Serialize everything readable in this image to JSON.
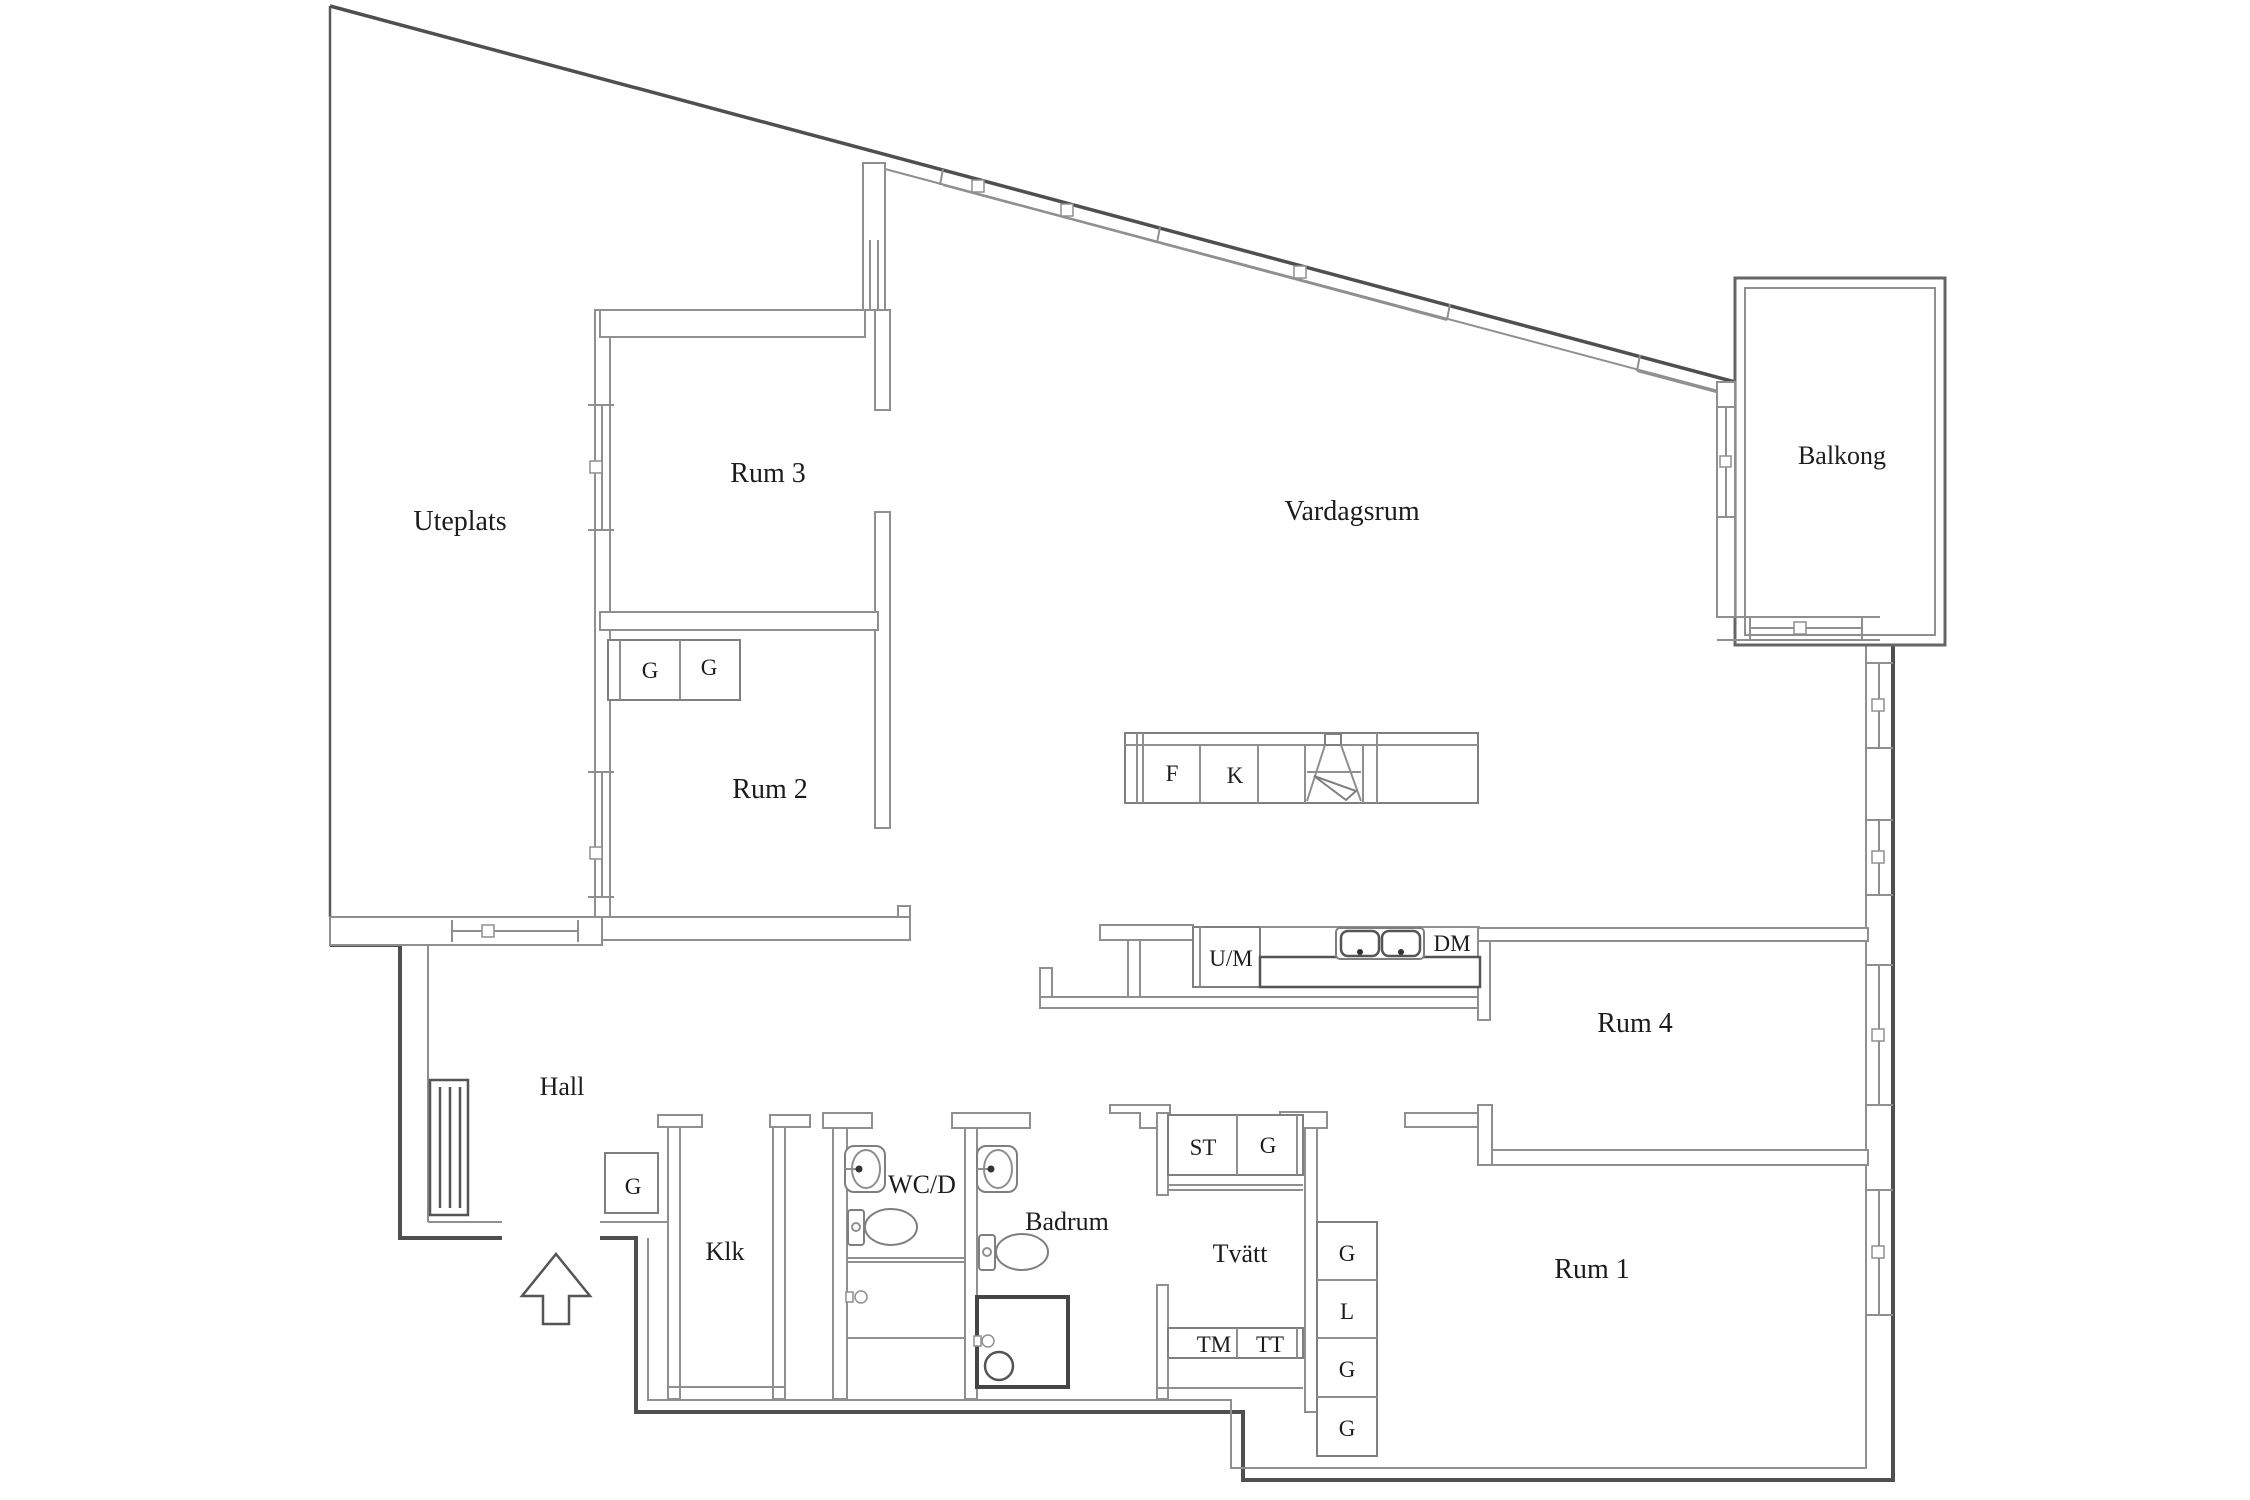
{
  "document": {
    "type": "architectural floor plan",
    "background": "#ffffff"
  },
  "colors": {
    "outer_wall": "#4f4f4f",
    "inner_wall": "#8f8f8f",
    "fixture_line": "#7f7f7f",
    "shower_outline": "#454545",
    "label_text": "#1c1c1c"
  },
  "rooms": {
    "uteplats": "Uteplats",
    "rum3": "Rum 3",
    "rum2": "Rum 2",
    "vardagsrum": "Vardagsrum",
    "balkong": "Balkong",
    "rum4": "Rum 4",
    "rum1": "Rum 1",
    "hall": "Hall",
    "klk": "Klk",
    "wcd": "WC/D",
    "badrum": "Badrum",
    "tvatt": "Tvätt"
  },
  "kitchen": {
    "f": "F",
    "k": "K",
    "um": "U/M",
    "dm": "DM"
  },
  "laundry": {
    "st": "ST",
    "g": "G",
    "tm": "TM",
    "tt": "TT"
  },
  "cabinets": {
    "column": [
      "G",
      "L",
      "G",
      "G"
    ],
    "rum2": [
      "G",
      "G"
    ],
    "hall": "G"
  },
  "icons": [
    "entry-arrow-icon",
    "radiator-icon",
    "stove-icon",
    "sink-basin-icon",
    "washbasin-icon",
    "toilet-icon",
    "shower-icon",
    "drain-icon",
    "window-icon"
  ]
}
